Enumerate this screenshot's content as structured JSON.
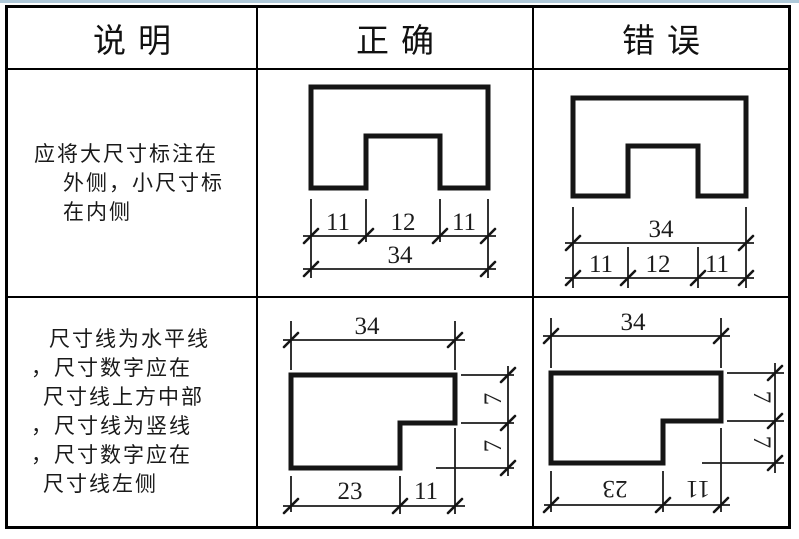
{
  "page": {
    "top_line_color": "#aec8d8"
  },
  "table": {
    "headers": [
      {
        "label": "说明"
      },
      {
        "label": "正确"
      },
      {
        "label": "错误"
      }
    ],
    "rows": [
      {
        "description_lines": [
          "应将大尺寸标注在",
          "外侧，小尺寸标",
          "在内侧"
        ]
      },
      {
        "description_lines": [
          "尺寸线为水平线",
          "，尺寸数字应在",
          "尺寸线上方中部",
          "，尺寸线为竖线",
          "，尺寸数字应在",
          "尺寸线左侧"
        ]
      }
    ],
    "figures": {
      "row1_correct": {
        "segments": [
          "11",
          "12",
          "11"
        ],
        "total": "34"
      },
      "row1_wrong": {
        "total": "34",
        "segments": [
          "11",
          "12",
          "11"
        ]
      },
      "row2_correct": {
        "top_total": "34",
        "right_segments": [
          "7",
          "7"
        ],
        "bottom_segments": [
          "23",
          "11"
        ]
      },
      "row2_wrong": {
        "top_total": "34",
        "right_segments": [
          "7",
          "7"
        ],
        "bottom_segments": [
          "23",
          "11"
        ]
      }
    }
  }
}
